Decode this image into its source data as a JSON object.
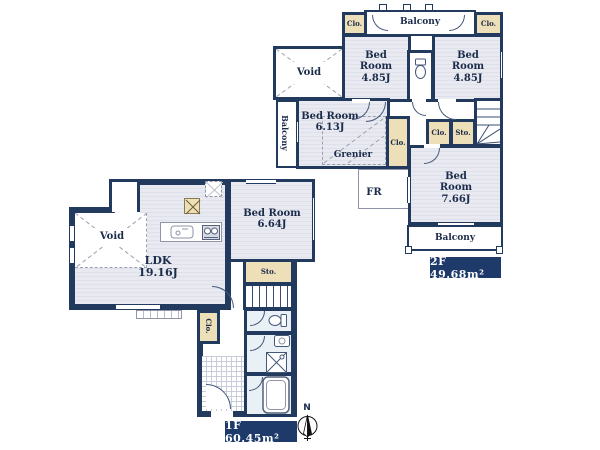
{
  "title": "floor-plan",
  "floor2": {
    "area_label": "2F 49.68m²",
    "balcony_top": "Balcony",
    "balcony_left": "Balcony",
    "balcony_bottom": "Balcony",
    "clo_top_left": "Clo.",
    "clo_top_right": "Clo.",
    "clo_hall": "Clo.",
    "clo_small": "Clo.",
    "sto_small": "Sto.",
    "void": "Void",
    "grenier": "Grenier",
    "fr": "FR",
    "bedroom_nw": {
      "name": "Bed Room",
      "size": "4.85J"
    },
    "bedroom_ne": {
      "name": "Bed Room",
      "size": "4.85J"
    },
    "bedroom_w": {
      "name": "Bed Room",
      "size": "6.13J"
    },
    "bedroom_se": {
      "name": "Bed Room",
      "size": "7.66J"
    }
  },
  "floor1": {
    "area_label": "1F 60.45m²",
    "ldk": {
      "name": "LDK",
      "size": "19.16J"
    },
    "void": "Void",
    "bedroom": {
      "name": "Bed Room",
      "size": "6.64J"
    },
    "sto": "Sto.",
    "clo": "Clo."
  },
  "compass": {
    "north": "N"
  },
  "colors": {
    "wall": "#223a5e",
    "room_fill": "#e9eaf1",
    "closet_fill": "#eddfb8",
    "wet_fill": "#eaf1f6",
    "area_label_bg": "#1d3a6a",
    "area_label_text": "#ffffff"
  }
}
